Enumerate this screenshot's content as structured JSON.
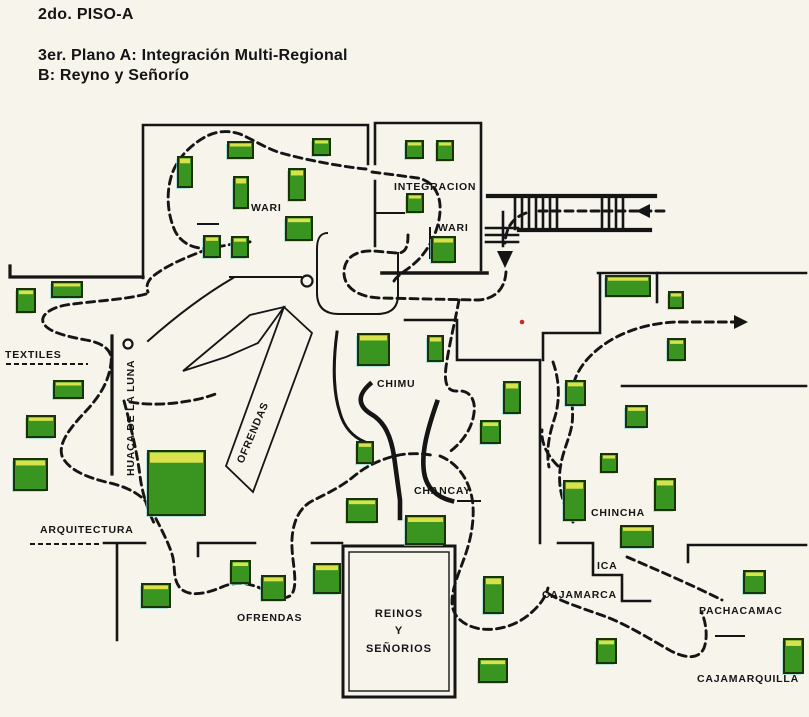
{
  "title": {
    "line1": "2do. PISO-A",
    "line2": "3er. Plano A: Integración Multi-Regional",
    "line3": "B: Reyno y Señorío"
  },
  "colors": {
    "background": "#f7f4ec",
    "line": "#151515",
    "case_fill": "#3a9420",
    "case_highlight": "#d9e24b",
    "case_border": "#1b3206",
    "case_shadow": "#8fd8d2",
    "red_dot": "#cc2a2a"
  },
  "map": {
    "labels": [
      {
        "name": "wari-a",
        "text": "WARI",
        "x": 251,
        "y": 211
      },
      {
        "name": "integracion",
        "text": "INTEGRACION",
        "x": 394,
        "y": 190
      },
      {
        "name": "wari-b",
        "text": "WARI",
        "x": 438,
        "y": 231
      },
      {
        "name": "textiles",
        "text": "TEXTILES",
        "x": 5,
        "y": 358
      },
      {
        "name": "huaca-de-la-luna",
        "text": "HUACA DE LA LUNA",
        "x": 134,
        "y": 476,
        "rotate": -90
      },
      {
        "name": "ofrendas-hut",
        "text": "OFRENDAS",
        "x": 243,
        "y": 464,
        "rotate": -67
      },
      {
        "name": "chimu",
        "text": "CHIMU",
        "x": 377,
        "y": 387
      },
      {
        "name": "chancay",
        "text": "CHANCAY",
        "x": 414,
        "y": 494
      },
      {
        "name": "chincha",
        "text": "CHINCHA",
        "x": 591,
        "y": 516
      },
      {
        "name": "ica",
        "text": "ICA",
        "x": 597,
        "y": 569
      },
      {
        "name": "cajamarca",
        "text": "CAJAMARCA",
        "x": 542,
        "y": 598
      },
      {
        "name": "pachacamac",
        "text": "PACHACAMAC",
        "x": 699,
        "y": 614
      },
      {
        "name": "cajamarquilla",
        "text": "CAJAMARQUILLA",
        "x": 697,
        "y": 682
      },
      {
        "name": "arquitectura",
        "text": "ARQUITECTURA",
        "x": 40,
        "y": 533
      },
      {
        "name": "ofrendas-sala",
        "text": "OFRENDAS",
        "x": 237,
        "y": 621
      }
    ],
    "reinos": {
      "outer": [
        343,
        546,
        112,
        151
      ],
      "inner": [
        349,
        552,
        100,
        139
      ],
      "cx": 399,
      "lines": [
        {
          "t": "REINOS",
          "y": 617
        },
        {
          "t": "Y",
          "y": 634
        },
        {
          "t": "SEÑORIOS",
          "y": 652
        }
      ]
    },
    "display_cases": [
      [
        228,
        142,
        25,
        16
      ],
      [
        178,
        157,
        14,
        30
      ],
      [
        234,
        177,
        14,
        31
      ],
      [
        313,
        139,
        17,
        16
      ],
      [
        289,
        169,
        16,
        31
      ],
      [
        286,
        217,
        26,
        23
      ],
      [
        204,
        236,
        16,
        21
      ],
      [
        232,
        237,
        16,
        20
      ],
      [
        406,
        141,
        17,
        17
      ],
      [
        437,
        141,
        16,
        19
      ],
      [
        407,
        194,
        16,
        18
      ],
      [
        432,
        237,
        23,
        25
      ],
      [
        606,
        276,
        44,
        20
      ],
      [
        669,
        292,
        14,
        16
      ],
      [
        668,
        339,
        17,
        21
      ],
      [
        626,
        406,
        21,
        21
      ],
      [
        17,
        289,
        18,
        23
      ],
      [
        52,
        282,
        30,
        15
      ],
      [
        54,
        381,
        29,
        17
      ],
      [
        27,
        416,
        28,
        21
      ],
      [
        14,
        459,
        33,
        31
      ],
      [
        148,
        451,
        57,
        64
      ],
      [
        358,
        334,
        31,
        31
      ],
      [
        428,
        336,
        15,
        25
      ],
      [
        357,
        442,
        16,
        21
      ],
      [
        347,
        499,
        30,
        23
      ],
      [
        504,
        382,
        16,
        31
      ],
      [
        481,
        421,
        19,
        22
      ],
      [
        566,
        381,
        19,
        24
      ],
      [
        601,
        454,
        16,
        18
      ],
      [
        564,
        481,
        21,
        39
      ],
      [
        655,
        479,
        20,
        31
      ],
      [
        621,
        526,
        32,
        21
      ],
      [
        406,
        516,
        39,
        28
      ],
      [
        142,
        584,
        28,
        23
      ],
      [
        231,
        561,
        19,
        22
      ],
      [
        262,
        576,
        23,
        24
      ],
      [
        314,
        564,
        26,
        29
      ],
      [
        484,
        577,
        19,
        36
      ],
      [
        479,
        659,
        28,
        23
      ],
      [
        597,
        639,
        19,
        24
      ],
      [
        744,
        571,
        21,
        22
      ],
      [
        784,
        639,
        19,
        34
      ]
    ],
    "walls": [
      {
        "name": "wall-wari-room",
        "d": "M143,278 V125 H368 V164",
        "w": 2.6
      },
      {
        "name": "wall-left-wing",
        "d": "M10,266 V277 H143",
        "w": 3.2
      },
      {
        "name": "wall-integracion-outline",
        "d": "M375,164 V123 H481 V270",
        "w": 2.6
      },
      {
        "name": "wall-integracion-left",
        "d": "M375,181 V246",
        "w": 2.6
      },
      {
        "name": "wall-integracion-bottom",
        "d": "M382,273 H487",
        "w": 3.6
      },
      {
        "name": "wall-integracion-stub",
        "d": "M375,213 H404",
        "w": 2
      },
      {
        "name": "wall-integracion-stub2",
        "d": "M430,228 V258",
        "w": 2
      },
      {
        "name": "wall-wari-room-bottom",
        "d": "M230,277 H301",
        "w": 2
      },
      {
        "name": "wall-curve-center-left",
        "d": "M148,341 Q192,302 233,278",
        "w": 2
      },
      {
        "name": "wall-u-corridor",
        "d": "M327,233 Q317,233 317,249 V293 Q317,314 339,314 H377 Q398,314 398,295 V253",
        "w": 2
      },
      {
        "name": "wall-top-right-corridor",
        "d": "M598,273 H806",
        "w": 2.6
      },
      {
        "name": "wall-corridor-tick",
        "d": "M657,273 V302",
        "w": 2.6
      },
      {
        "name": "wall-mid-right-corridor",
        "d": "M622,386 H806",
        "w": 2.6
      },
      {
        "name": "wall-center-block-outer",
        "d": "M405,320 H457 V360 H540 V543",
        "w": 2.6
      },
      {
        "name": "wall-center-block-inner",
        "d": "M600,274 V333 H543 V360",
        "w": 2.6
      },
      {
        "name": "wall-ica-steps",
        "d": "M558,543 H593 V575 H622 V601 H650",
        "w": 2.6
      },
      {
        "name": "wall-pachacamac-room",
        "d": "M688,545 H806 M688,545 V562",
        "w": 2.6
      },
      {
        "name": "wall-arquitectura",
        "d": "M104,543 H145 M117,543 V640",
        "w": 2.6
      },
      {
        "name": "wall-ofrendas-a",
        "d": "M198,543 H255 M198,543 V556",
        "w": 2.6
      },
      {
        "name": "wall-ofrendas-b",
        "d": "M312,543 H342",
        "w": 2.6
      },
      {
        "name": "wall-bold-wavy",
        "d": "M370,384 C357,395 358,406 371,414 C385,422 391,437 394,456 C397,477 399,492 400,500 V518",
        "w": 4.6
      },
      {
        "name": "wall-bold-curve",
        "d": "M437,402 C428,428 421,452 424,472 C426,487 436,497 452,501",
        "w": 4.6
      },
      {
        "name": "wall-medium-vertical",
        "d": "M337,332 C333,362 333,392 340,413 C344,427 353,437 365,442",
        "w": 3
      },
      {
        "name": "huaca-ramp-line",
        "d": "M112,336 V474",
        "w": 3.2
      },
      {
        "name": "stair-rail-top",
        "d": "M488,196 H655",
        "w": 4.2
      },
      {
        "name": "stair-rail-bottom",
        "d": "M519,230 H650",
        "w": 4.2
      },
      {
        "name": "stair-treads-a",
        "d": "M515,197 V229 M522,197 V229 M529,197 V229 M536,197 V229 M543,197 V229 M550,197 V229 M557,197 V229",
        "w": 2.6
      },
      {
        "name": "stair-treads-b",
        "d": "M602,197 V229 M609,197 V229 M616,197 V229 M623,197 V229",
        "w": 2.6
      },
      {
        "name": "stair-small-flight",
        "d": "M486,228 H518 M486,235 H518 M486,242 H518 M503,212 V246",
        "w": 2.6
      },
      {
        "name": "label-dash-wari",
        "d": "M198,224 H218",
        "w": 2
      },
      {
        "name": "label-dash-chancay",
        "d": "M458,501 H480",
        "w": 2
      },
      {
        "name": "label-dash-pachacamac",
        "d": "M716,636 H744",
        "w": 2
      }
    ],
    "dashed_underlines": [
      {
        "name": "underline-textiles",
        "d": "M6,364 H88"
      },
      {
        "name": "underline-arquitectura",
        "d": "M30,544 H102"
      }
    ],
    "ofrendas_shape": [
      {
        "name": "ofrendas-gable",
        "d": "M183,371 L250,315 L284,307 L258,343 L226,357 Z"
      },
      {
        "name": "ofrendas-band",
        "d": "M284,307 L312,333 L253,492 L226,466 Z"
      }
    ],
    "routes": [
      {
        "name": "route-stairs-run",
        "d": "M664,211 H534"
      },
      {
        "name": "route-stairs-turn",
        "d": "M526,213 C512,218 506,228 505,243"
      },
      {
        "name": "route-hall-u-turn",
        "d": "M506,272 C505,288 496,299 478,300 L380,298 C356,297 343,286 344,271 C345,257 357,250 374,251 L396,253 C407,254 408,244 408,235"
      },
      {
        "name": "route-integracion-loop",
        "d": "M372,172 L418,178 C432,181 439,192 440,205 C441,222 434,242 420,258 C410,269 398,274 394,281"
      },
      {
        "name": "route-wari-loop",
        "d": "M366,169 C345,167 310,161 281,153 C265,148 252,139 240,134 C228,130 216,131 205,137 C191,145 178,157 172,174 C166,192 167,213 175,231 C181,243 194,250 210,248 C226,246 242,241 254,242"
      },
      {
        "name": "route-wari-exit",
        "d": "M208,249 C190,256 168,264 152,277 C147,282 146,287 148,292"
      },
      {
        "name": "route-textiles-loop",
        "d": "M146,294 C124,300 92,301 66,305 C50,308 41,315 43,322 C46,331 64,336 86,340 C104,343 113,351 111,363 C109,381 100,396 86,411 C70,428 58,443 62,456 C68,470 88,478 110,483 C127,487 140,494 147,503"
      },
      {
        "name": "route-huaca-strand",
        "d": "M124,401 C131,427 137,452 140,476 C142,492 147,508 154,523"
      },
      {
        "name": "route-hut-branch",
        "d": "M130,402 C152,406 176,404 199,399 C207,397 213,395 218,393"
      },
      {
        "name": "route-ofrendas-sweep",
        "d": "M150,507 C158,523 167,539 172,554 C176,567 172,578 180,588 C190,598 208,593 222,587 C238,580 254,584 268,592 C280,599 291,601 294,589 C297,576 291,557 292,539 C293,522 299,508 312,501 C326,494 341,487 353,477 C365,467 377,461 391,457 C404,453 418,453 431,455"
      },
      {
        "name": "route-chimu",
        "d": "M459,300 C455,322 449,345 446,367 C444,383 447,392 458,391 C469,390 476,399 474,413 C472,429 462,443 448,453"
      },
      {
        "name": "route-chancay-loop",
        "d": "M440,456 C457,463 468,478 472,498 C475,515 472,535 466,553 C460,571 452,587 452,602 C452,616 463,626 481,629 C499,631 518,625 532,612 C541,604 546,596 548,588"
      },
      {
        "name": "route-cajamarca-sweep",
        "d": "M549,594 C562,602 582,608 604,616 C626,624 650,639 671,651 C687,659 699,659 704,648 C708,637 706,623 702,613"
      },
      {
        "name": "route-pachacamac-diagonal",
        "d": "M627,557 C655,569 692,585 722,600"
      },
      {
        "name": "route-chincha-corridor",
        "d": "M553,362 C560,382 560,402 554,420 C549,435 546,452 549,467"
      },
      {
        "name": "route-chincha-fork",
        "d": "M558,466 C547,455 541,443 542,430"
      },
      {
        "name": "route-exit-up",
        "d": "M573,522 C563,505 558,488 560,470 C562,452 570,438 572,424 C574,410 570,398 573,386 C577,368 591,352 611,340 C630,329 652,323 676,322 L734,322"
      }
    ],
    "arrows": [
      {
        "name": "arrow-entry-left",
        "points": "636,211 650,204 650,218"
      },
      {
        "name": "arrow-stairs-down",
        "points": "505,268 497,251 513,251"
      },
      {
        "name": "arrow-exit-right",
        "points": "748,322 734,315 734,329"
      }
    ],
    "circles": [
      {
        "name": "column-marker-center",
        "cx": 307,
        "cy": 281,
        "r": 5.5
      },
      {
        "name": "column-marker-huaca",
        "cx": 128,
        "cy": 344,
        "r": 4.5
      }
    ],
    "red_dot": {
      "cx": 522,
      "cy": 322,
      "r": 2.3
    }
  }
}
